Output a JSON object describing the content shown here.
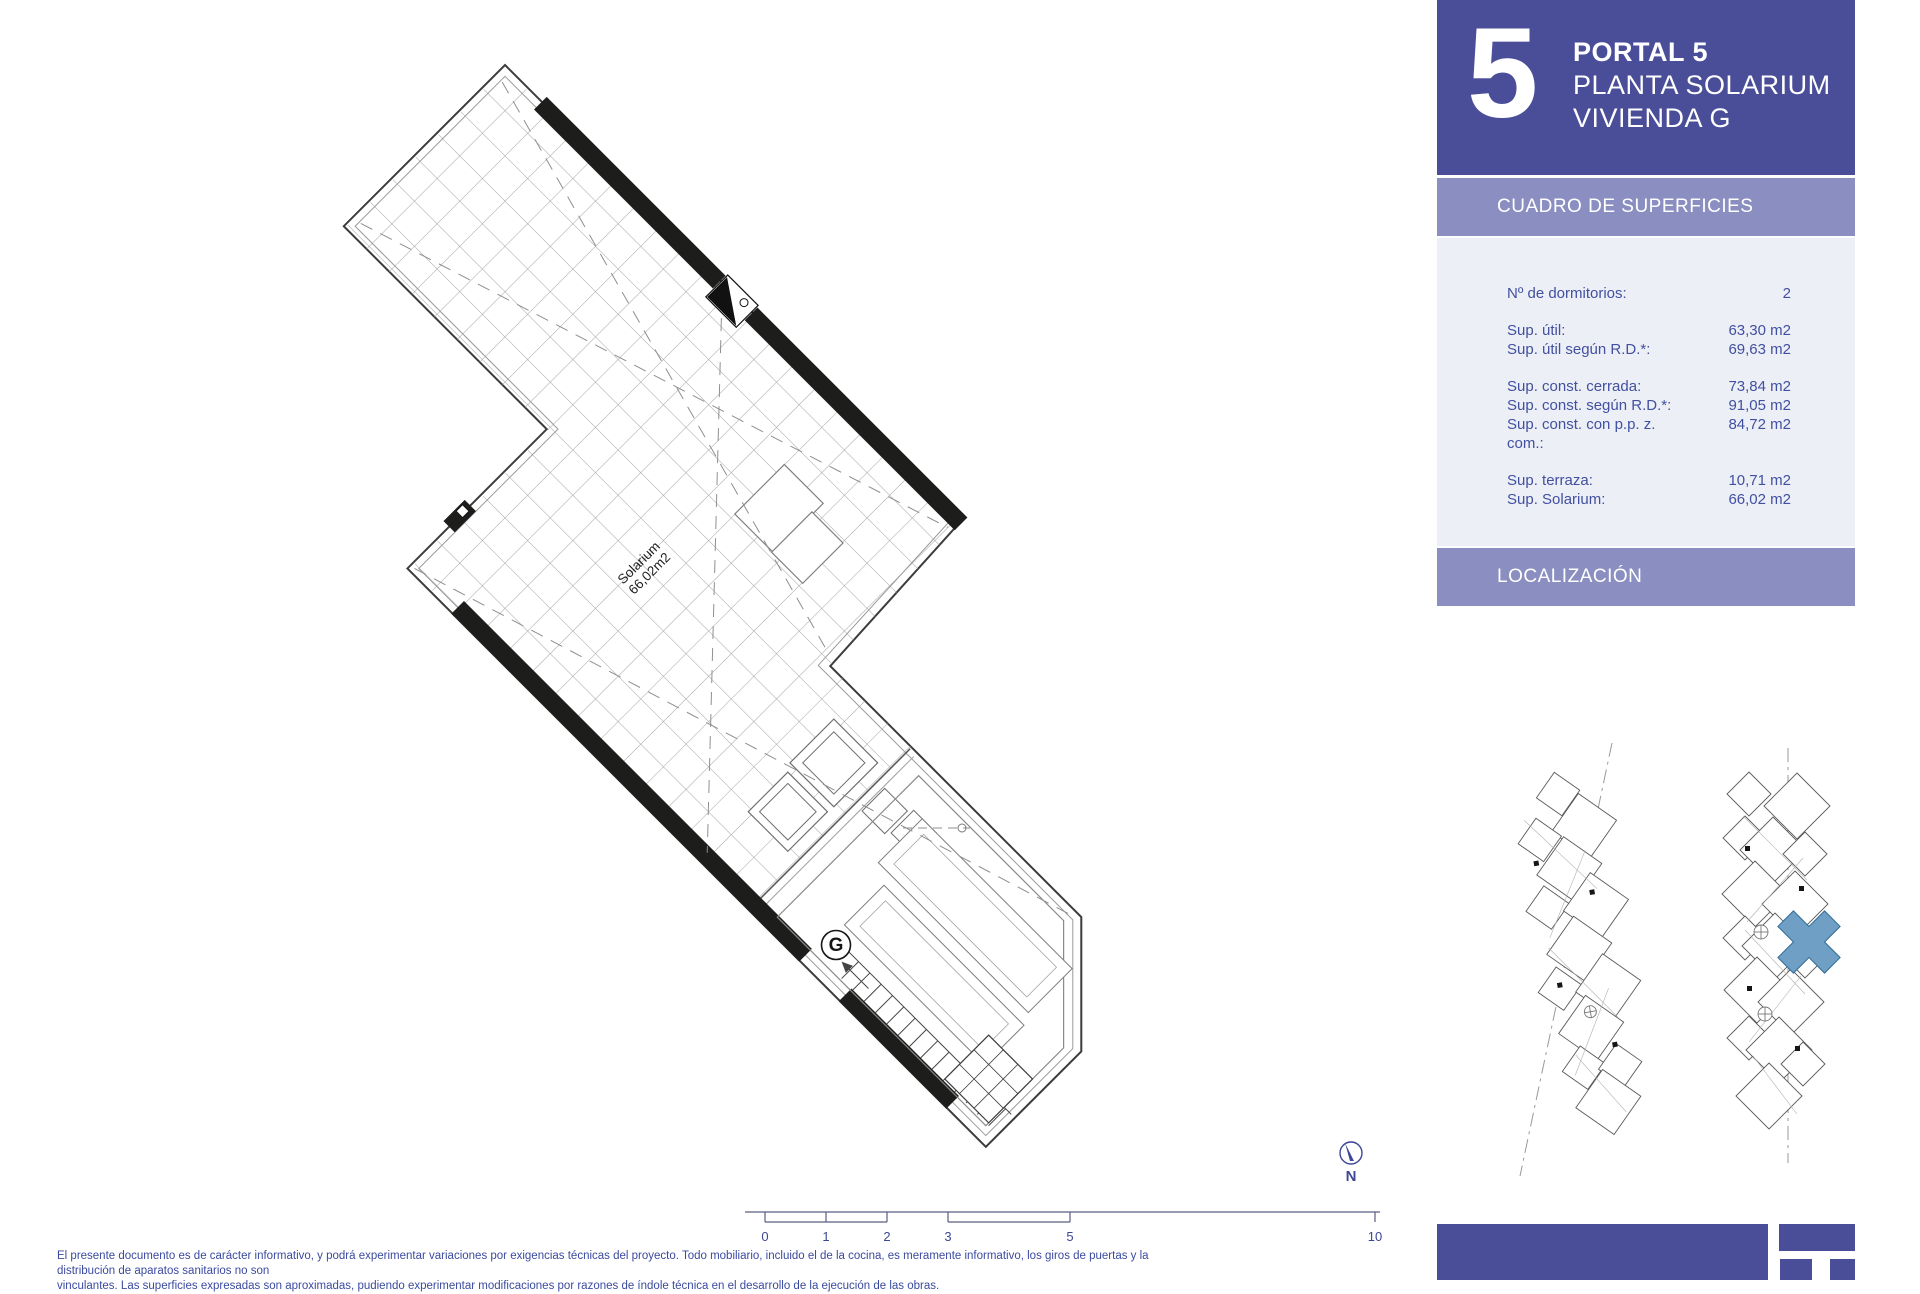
{
  "header": {
    "portal_number": "5",
    "line1": "PORTAL 5",
    "line2": "PLANTA SOLARIUM",
    "line3": "VIVIENDA G"
  },
  "surfaces": {
    "title": "CUADRO DE SUPERFICIES",
    "rows": [
      {
        "label": "Nº de dormitorios:",
        "value": "2"
      },
      {
        "label": "Sup. útil:",
        "value": "63,30 m2"
      },
      {
        "label": "Sup. útil según R.D.*:",
        "value": "69,63 m2"
      },
      {
        "label": "Sup. const. cerrada:",
        "value": "73,84 m2"
      },
      {
        "label": "Sup. const. según R.D.*:",
        "value": "91,05 m2"
      },
      {
        "label": "Sup. const. con p.p. z. com.:",
        "value": "84,72 m2"
      },
      {
        "label": "Sup. terraza:",
        "value": "10,71 m2"
      },
      {
        "label": "Sup. Solarium:",
        "value": "66,02 m2"
      }
    ]
  },
  "localizacion": {
    "title": "LOCALIZACIÓN"
  },
  "plan": {
    "room_label_line1": "Solarium",
    "room_label_line2": "66,02m2",
    "unit_letter": "G",
    "north_label": "N",
    "scale_ticks": [
      "0",
      "1",
      "2",
      "3",
      "5",
      "10"
    ]
  },
  "footer": {
    "line1": "El presente documento es de carácter informativo, y podrá experimentar variaciones por exigencias técnicas del proyecto. Todo mobiliario, incluido el de la cocina, es meramente informativo, los giros de puertas y la distribución de aparatos sanitarios no son",
    "line2": "vinculantes. Las superficies expresadas son aproximadas, pudiendo experimentar modificaciones por razones de índole técnica en el desarrollo de la ejecución de las obras."
  },
  "colors": {
    "header_purple": "#4a4e99",
    "band_purple": "#8a8ec0",
    "table_bg": "#edeff6",
    "table_text": "#4150a0",
    "accent_navy": "#3d4795",
    "highlight_blue": "#6f9fc4",
    "wall_black": "#1d1d1b"
  }
}
